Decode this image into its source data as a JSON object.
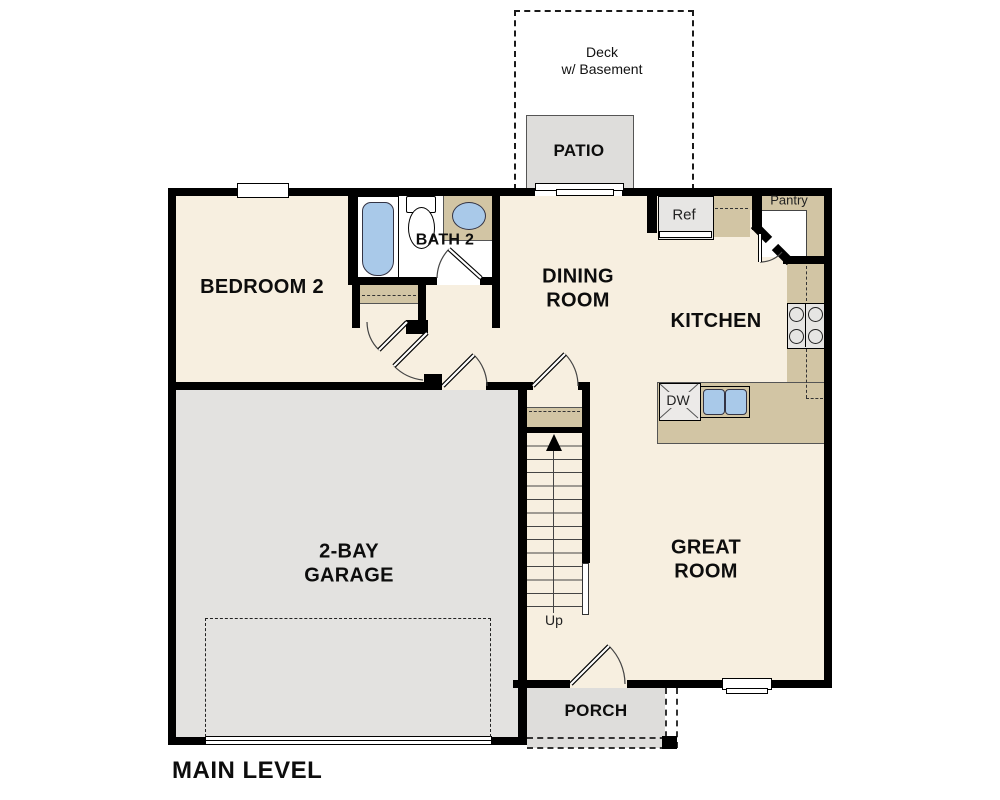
{
  "title": "MAIN LEVEL",
  "rooms": {
    "bedroom2": {
      "label": "BEDROOM 2"
    },
    "bath2": {
      "label": "BATH 2"
    },
    "dining": {
      "line1": "DINING",
      "line2": "ROOM"
    },
    "kitchen": {
      "label": "KITCHEN"
    },
    "great_room": {
      "line1": "GREAT",
      "line2": "ROOM"
    },
    "garage": {
      "line1": "2-BAY",
      "line2": "GARAGE"
    },
    "patio": {
      "label": "PATIO"
    },
    "porch": {
      "label": "PORCH"
    },
    "deck": {
      "line1": "Deck",
      "line2": "w/ Basement"
    }
  },
  "fixtures": {
    "refrigerator": "Ref",
    "pantry": "Pantry",
    "dishwasher": "DW",
    "stairs_direction": "Up"
  },
  "colors": {
    "wall": "#000000",
    "floor_cream": "#f7efe0",
    "garage_gray": "#e3e2e0",
    "patio_gray": "#dedddb",
    "counter_tan": "#d2c5a4",
    "fixture_blue": "#a9c9e9",
    "bath_white": "#ffffff"
  }
}
